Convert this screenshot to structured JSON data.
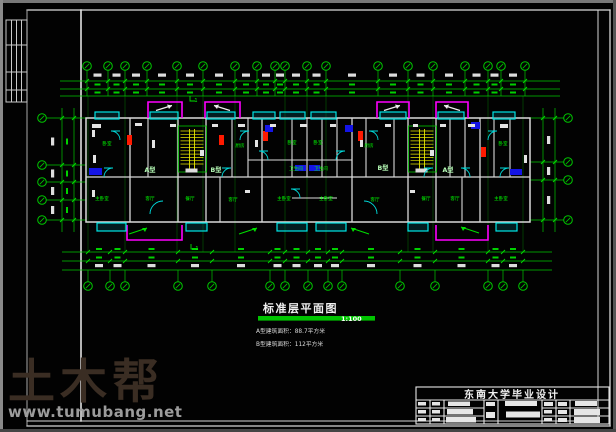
{
  "watermark": {
    "logo": "土木帮",
    "site": "www.tumubang.net"
  },
  "drawing_title": {
    "text": "标准层平面图",
    "scale": "1:100"
  },
  "notes": {
    "line1": "A型建筑面积：88.7平方米",
    "line2": "B型建筑面积：112平方米"
  },
  "title_block": {
    "header": "东南大学毕业设计"
  },
  "plan": {
    "unit_labels": [
      {
        "text": "A型",
        "x": 150,
        "y": 172
      },
      {
        "text": "B型",
        "x": 216,
        "y": 172
      },
      {
        "text": "B型",
        "x": 383,
        "y": 170
      },
      {
        "text": "A型",
        "x": 448,
        "y": 172
      }
    ],
    "room_labels": [
      {
        "text": "卧室",
        "x": 107,
        "y": 145
      },
      {
        "text": "卧室",
        "x": 292,
        "y": 144
      },
      {
        "text": "卧室",
        "x": 318,
        "y": 144
      },
      {
        "text": "卧室",
        "x": 503,
        "y": 145
      },
      {
        "text": "厨房",
        "x": 240,
        "y": 147
      },
      {
        "text": "厨房",
        "x": 369,
        "y": 147
      },
      {
        "text": "卫生间",
        "x": 296,
        "y": 170
      },
      {
        "text": "卫生间",
        "x": 321,
        "y": 170
      },
      {
        "text": "主卧室",
        "x": 102,
        "y": 200
      },
      {
        "text": "客厅",
        "x": 150,
        "y": 200
      },
      {
        "text": "餐厅",
        "x": 190,
        "y": 200
      },
      {
        "text": "客厅",
        "x": 233,
        "y": 201
      },
      {
        "text": "主卧室",
        "x": 284,
        "y": 200
      },
      {
        "text": "主卧室",
        "x": 326,
        "y": 200
      },
      {
        "text": "客厅",
        "x": 375,
        "y": 201
      },
      {
        "text": "餐厅",
        "x": 426,
        "y": 200
      },
      {
        "text": "客厅",
        "x": 455,
        "y": 200
      },
      {
        "text": "主卧室",
        "x": 501,
        "y": 200
      }
    ],
    "section_marks": [
      {
        "text": "1",
        "x": 196,
        "y": 102
      },
      {
        "text": "1",
        "x": 197,
        "y": 250
      }
    ]
  },
  "colors": {
    "axis_green": "#00c800",
    "label_green": "#00ff00",
    "window_cyan": "#00e5e5",
    "balcony_magenta": "#ff00ff",
    "stair_yellow": "#e8e800",
    "wall_white": "#d9d9d9",
    "fixture_red": "#ff1a00",
    "fixture_blue": "#1414e6",
    "scalebar_green": "#00c400",
    "watermark_brown": "#3a2d23",
    "watermark_gray": "#9c9c9c"
  }
}
